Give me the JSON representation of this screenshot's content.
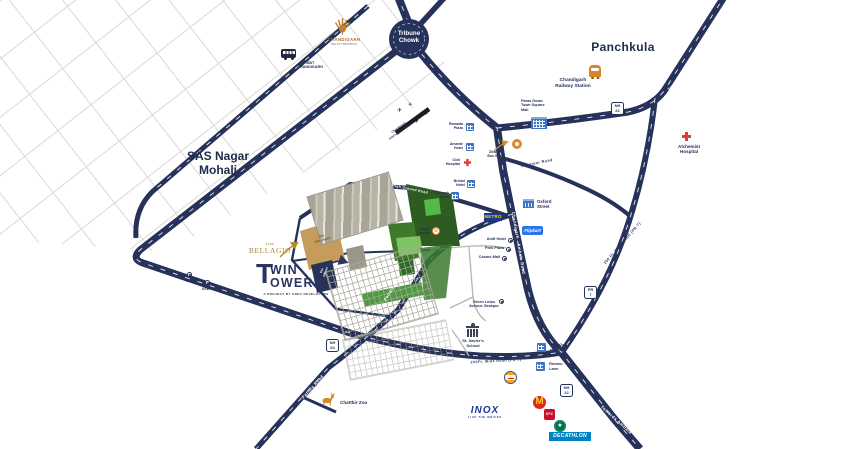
{
  "project": {
    "twin_t": "T",
    "twin_win": "WIN",
    "twin_owers": "OWERS",
    "tagline": "A PROJECT BY AREV DEVELOPERS",
    "bellagio_the": "THE",
    "bellagio_name": "BELLAGIO",
    "bellagio_block": "THE\nBELLAGIO",
    "offices_block": "The\nOffices"
  },
  "areas": {
    "panchkula": "Panchkula",
    "sas_nagar": "SAS Nagar\nMohali"
  },
  "junctions": {
    "tribune_chowk": "Tribune\nChowk"
  },
  "badges": {
    "nh22": "NH\n22",
    "pr7": "PR\n7",
    "nh64": "NH\n64"
  },
  "roads": {
    "towards_shimla": "Towards Shimla",
    "chandigarh_ambala": "Chandigarh - Ambala Road",
    "ghazipur": "Ghazipur Road",
    "patiala_upper": "Patiala Road",
    "patiala_lower": "Patiala Road",
    "intl_airport": "International Airport Road",
    "pr7_east": "200 Ft. Wide Road (PR-7)",
    "pr7_south": "200Ft. Wide Road (PR-7)",
    "high_ground": "High Ground Road",
    "towards_ambala": "Towards Ambala"
  },
  "pois": {
    "isbt": "ISBT\nCHANDIGARH",
    "chandigarh_city": "CHANDIGARH",
    "chandigarh_city_sub": "THE CITY BEAUTIFUL",
    "railway": "Chandigarh\nRailway Station",
    "alchemist": "Alchemist\nHospital",
    "paras_mall": "Paras Down\nTown Square\nMall",
    "bus_stand": "Zirakpur\nBus Stand",
    "airport": "Chandigarh\nInternational Airport",
    "ramada": "Ramada\nPlaza",
    "amante": "Amante\nHotel",
    "civil_hospital": "Civil\nHospital",
    "bristol": "Bristol\nHotel",
    "sunpark": "Sunpark\nHotel",
    "gopal": "Gopal\nSweets",
    "oxford": "Oxford\nStreet",
    "aloft": "Aloft Hotel",
    "park_plaza": "Park Plaza",
    "cosmo": "Cosmo Mall",
    "green_lotus": "Green Lotus\nAvenue Zirakpur",
    "st_xavier": "St. Xavier's\nSchool",
    "kleo": "The Kleo\nHotel",
    "romeo": "Romeo\nLane",
    "chattbir": "Chattbir Zoo",
    "isb": "ISB",
    "iiser": "IISER"
  },
  "brands": {
    "metro": "METRO",
    "flipkart": "Flipkart",
    "inox": "INOX",
    "inox_tagline": "LIVE THE MOVIES",
    "decathlon": "DECATHLON",
    "kfc": "KFC",
    "mcdonalds_m": "M"
  },
  "colors": {
    "road": "#26325a",
    "accent_orange": "#d4862a",
    "gold": "#a8862f",
    "navy_text": "#25305a",
    "red_cross": "#e03c31",
    "poi_blue": "#3f74c4",
    "green_dark": "#2e5b22",
    "green_mid": "#3f7a2b",
    "green_light": "#7cc464",
    "tan": "#c59c5c"
  }
}
